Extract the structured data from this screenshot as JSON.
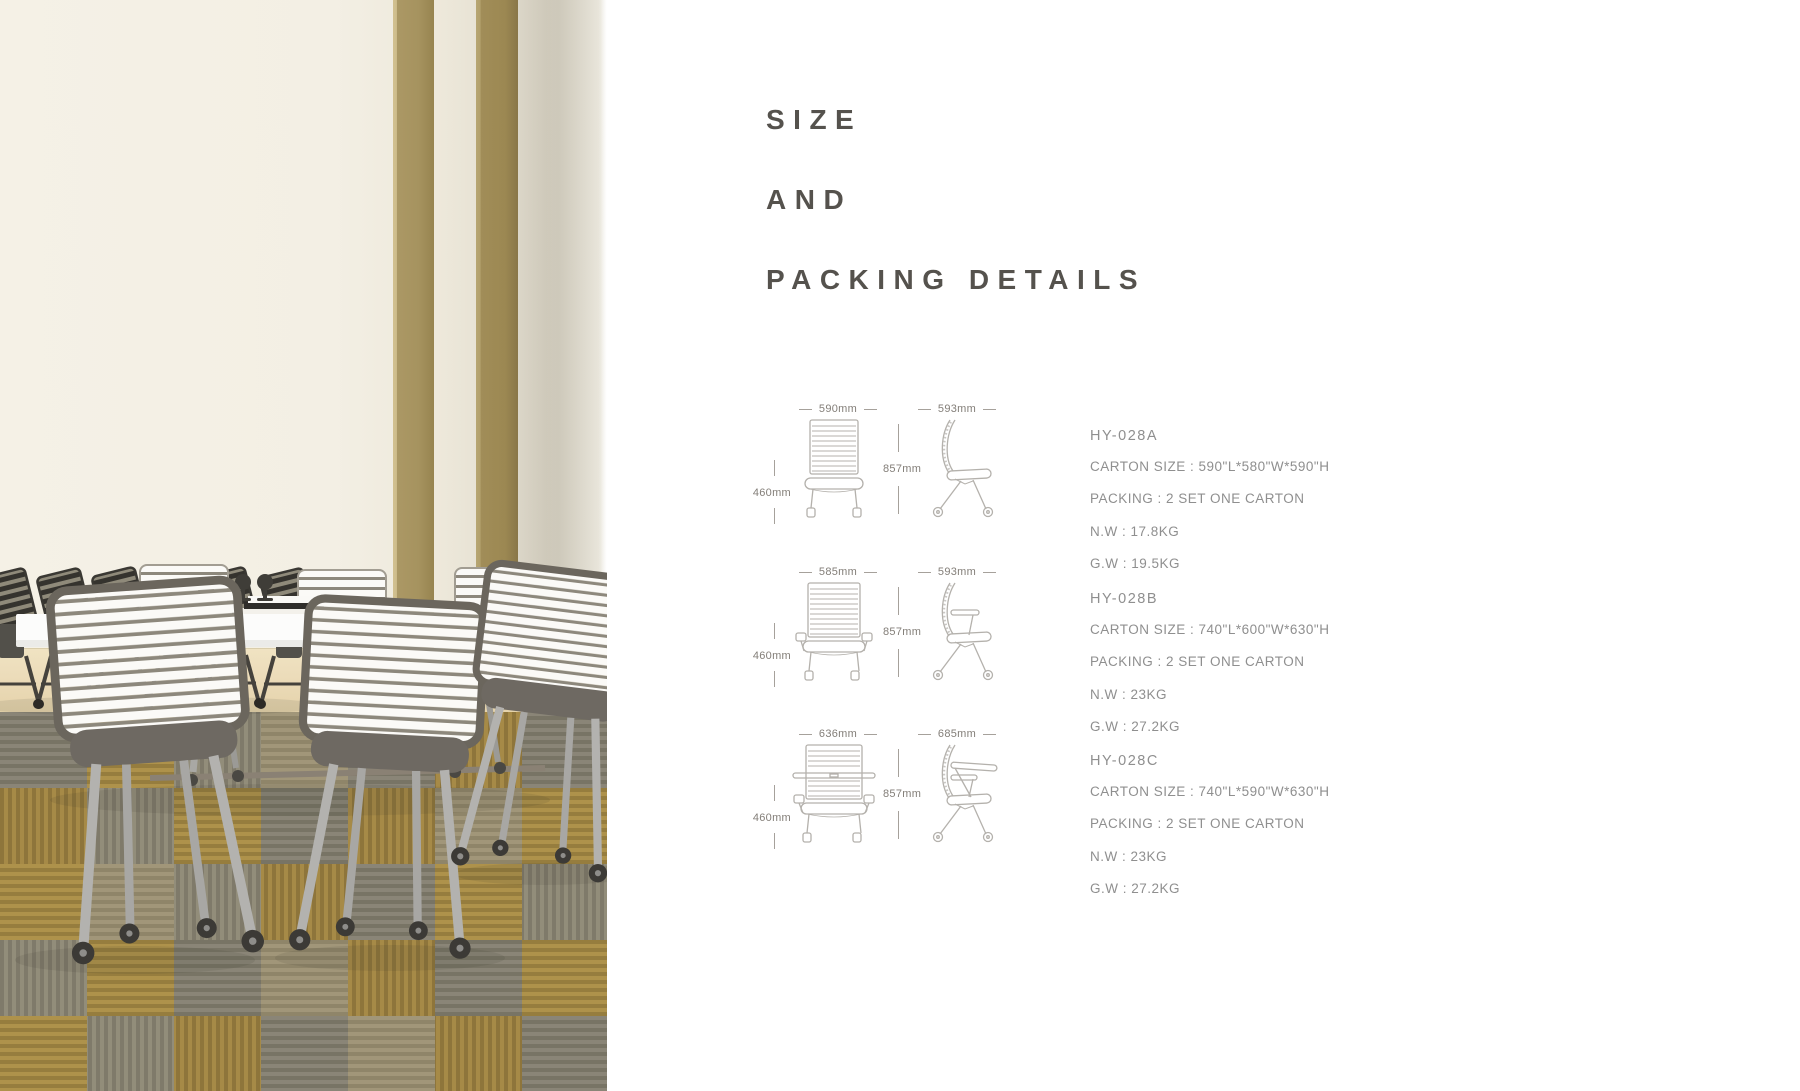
{
  "title": {
    "lines": [
      "SIZE",
      "AND",
      "PACKING DETAILS"
    ]
  },
  "products": [
    {
      "code": "HY-028A",
      "front_width": "590mm",
      "side_width": "593mm",
      "height": "857mm",
      "seat_height": "460mm",
      "specs": [
        "CARTON SIZE : 590\"L*580\"W*590\"H",
        "PACKING : 2 SET ONE CARTON",
        "N.W : 17.8KG",
        "G.W : 19.5KG"
      ]
    },
    {
      "code": "HY-028B",
      "front_width": "585mm",
      "side_width": "593mm",
      "height": "857mm",
      "seat_height": "460mm",
      "specs": [
        "CARTON SIZE : 740\"L*600\"W*630\"H",
        "PACKING : 2 SET ONE CARTON",
        "N.W : 23KG",
        "G.W : 27.2KG"
      ]
    },
    {
      "code": "HY-028C",
      "front_width": "636mm",
      "side_width": "685mm",
      "height": "857mm",
      "seat_height": "460mm",
      "specs": [
        "CARTON SIZE : 740\"L*590\"W*630\"H",
        "PACKING : 2 SET ONE CARTON",
        "N.W : 23KG",
        "G.W : 27.2KG"
      ]
    }
  ],
  "colors": {
    "title-text": "#55524d",
    "spec-text": "#8f8f8f",
    "dim-text": "#837e78",
    "drawing-line": "#b4b1ac",
    "wall-cream": "#f3efe4",
    "pillar-olive": "#a8945f",
    "wood-floor": "#ecdcba",
    "carpet-gold": "#b5974d",
    "carpet-gray": "#8d887a",
    "chair-seat-gray": "#6e6962",
    "chair-frame-silver": "#b3b2af",
    "table-white": "#fcfcfb"
  }
}
